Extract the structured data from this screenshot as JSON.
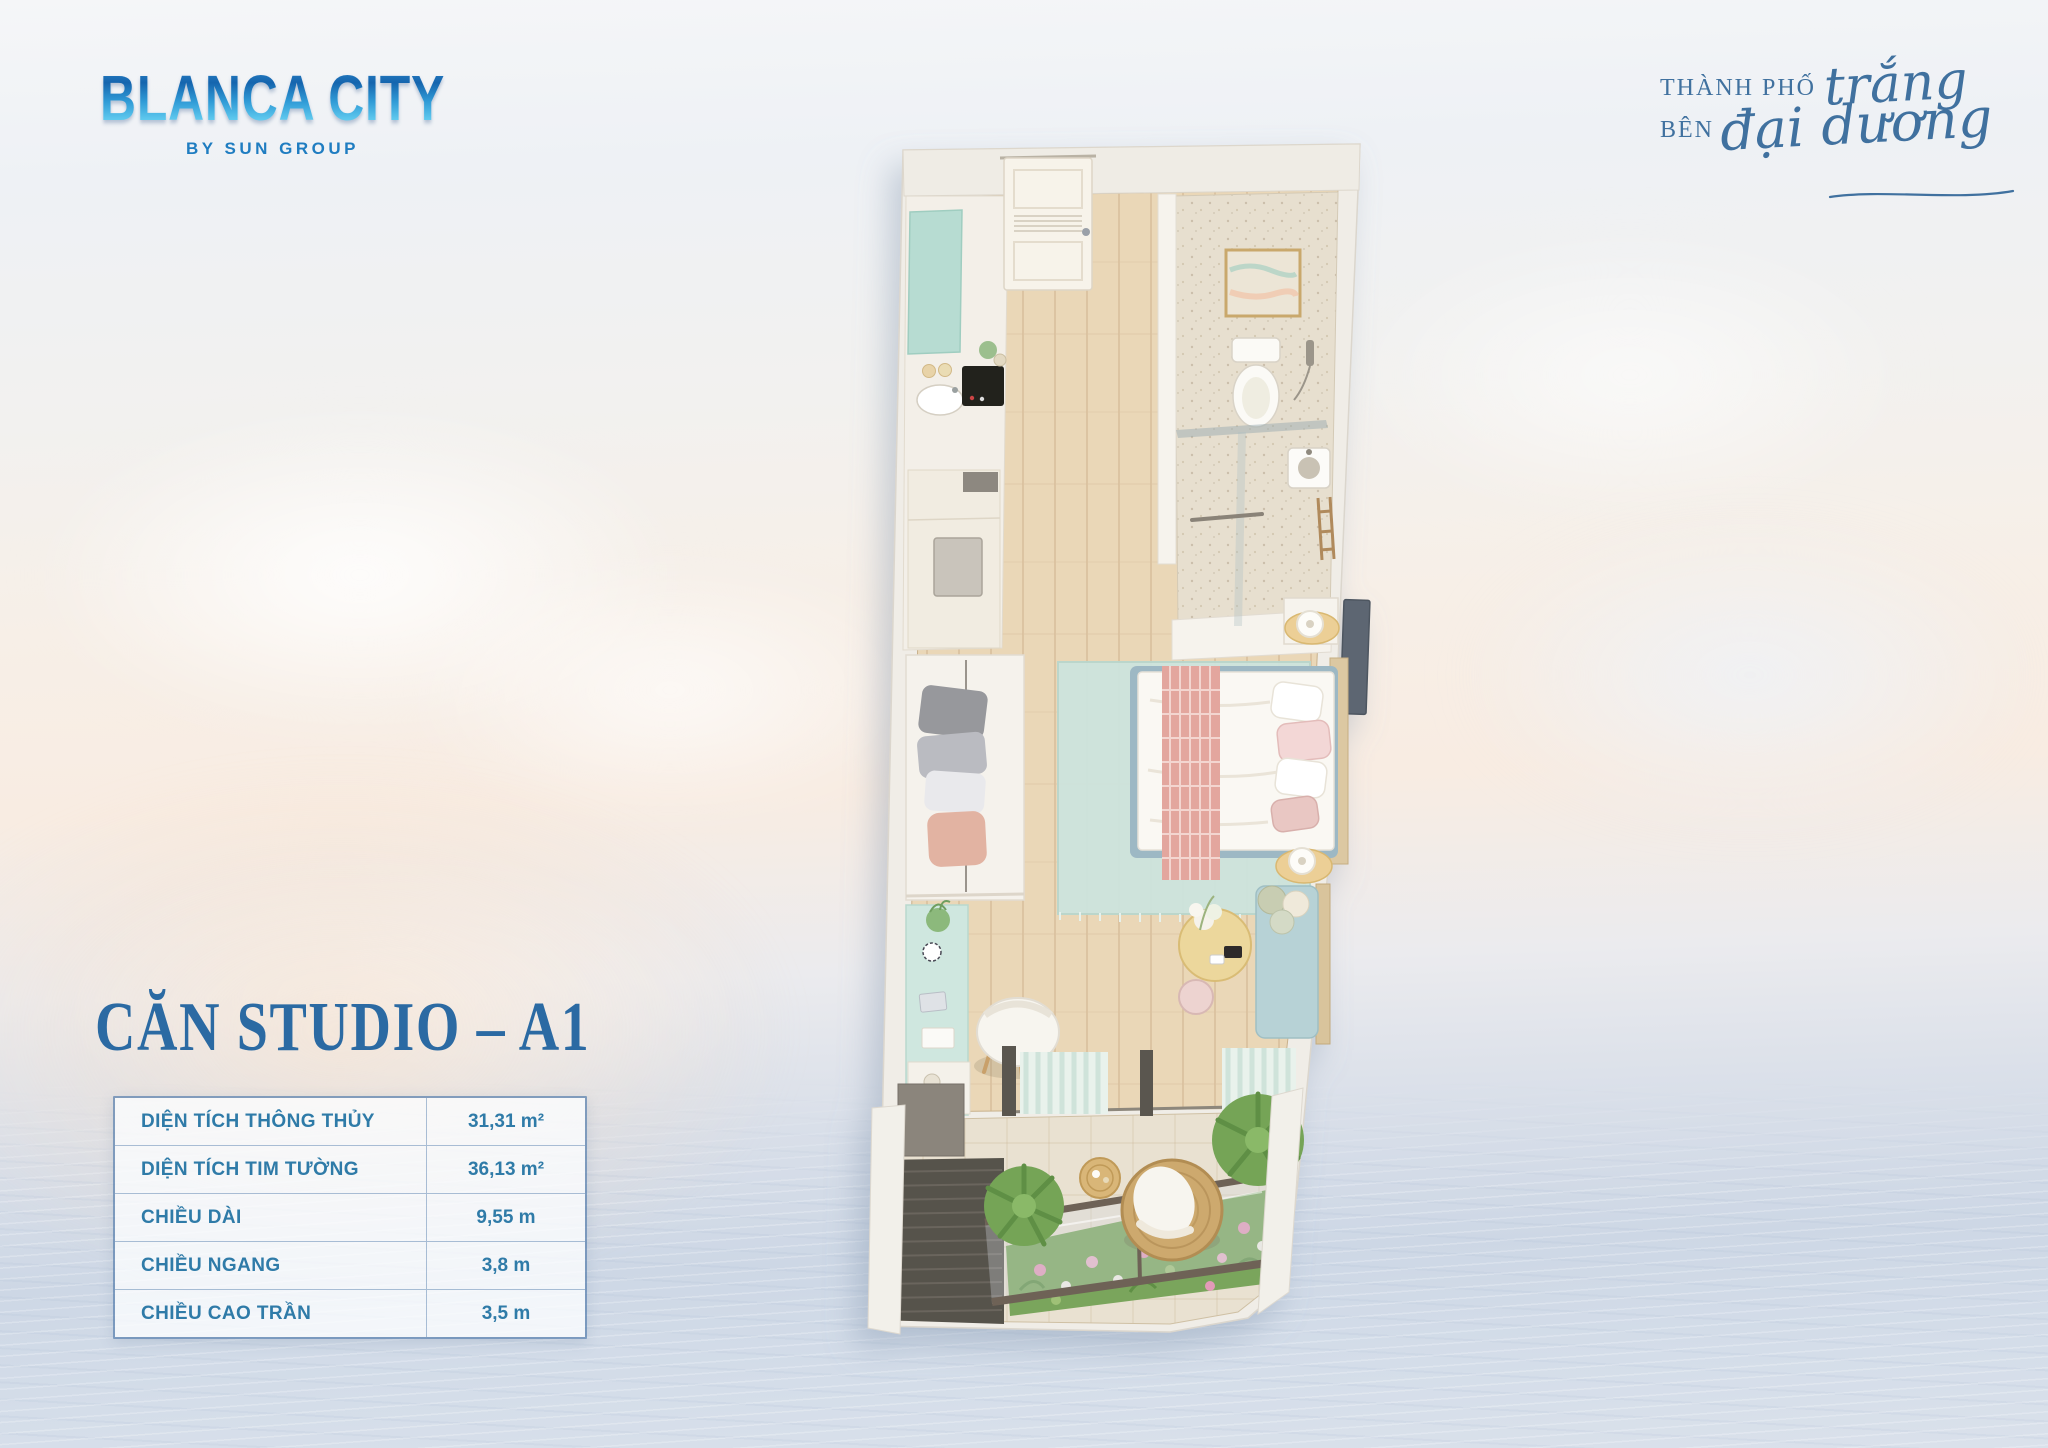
{
  "brand": {
    "logo_title": "BLANCA CITY",
    "logo_subtitle": "BY SUN GROUP",
    "logo_color_top": "#1565ae",
    "logo_color_bottom": "#63cdf0"
  },
  "tagline": {
    "line1_prefix": "THÀNH PHỐ",
    "line1_script": "trắng",
    "line2_prefix": "BÊN",
    "line2_script": "đại dương",
    "color": "#40719f"
  },
  "unit": {
    "title": "CĂN STUDIO – A1",
    "title_color": "#2b6aa3"
  },
  "specs": {
    "text_color": "#2f7ba8",
    "rows": [
      {
        "label": "DIỆN TÍCH THÔNG THỦY",
        "value": "31,31 m²"
      },
      {
        "label": "DIỆN TÍCH TIM TƯỜNG",
        "value": "36,13 m²"
      },
      {
        "label": "CHIỀU DÀI",
        "value": "9,55 m"
      },
      {
        "label": "CHIỀU NGANG",
        "value": "3,8 m"
      },
      {
        "label": "CHIỀU CAO TRẦN",
        "value": "3,5 m"
      }
    ]
  },
  "palette": {
    "sky": "#f2f3f6",
    "sunset_warm": "#f8ece2",
    "sea": "#ccd7e5",
    "wall_white": "#f0ede7",
    "wood_floor": "#e9d6b6",
    "mint_accent": "#c2e0d6",
    "rug_mint": "#cde4dd",
    "blush_pink": "#e3a69e",
    "balcony_green": "#6f9e56",
    "rattan_tan": "#cda96e"
  }
}
